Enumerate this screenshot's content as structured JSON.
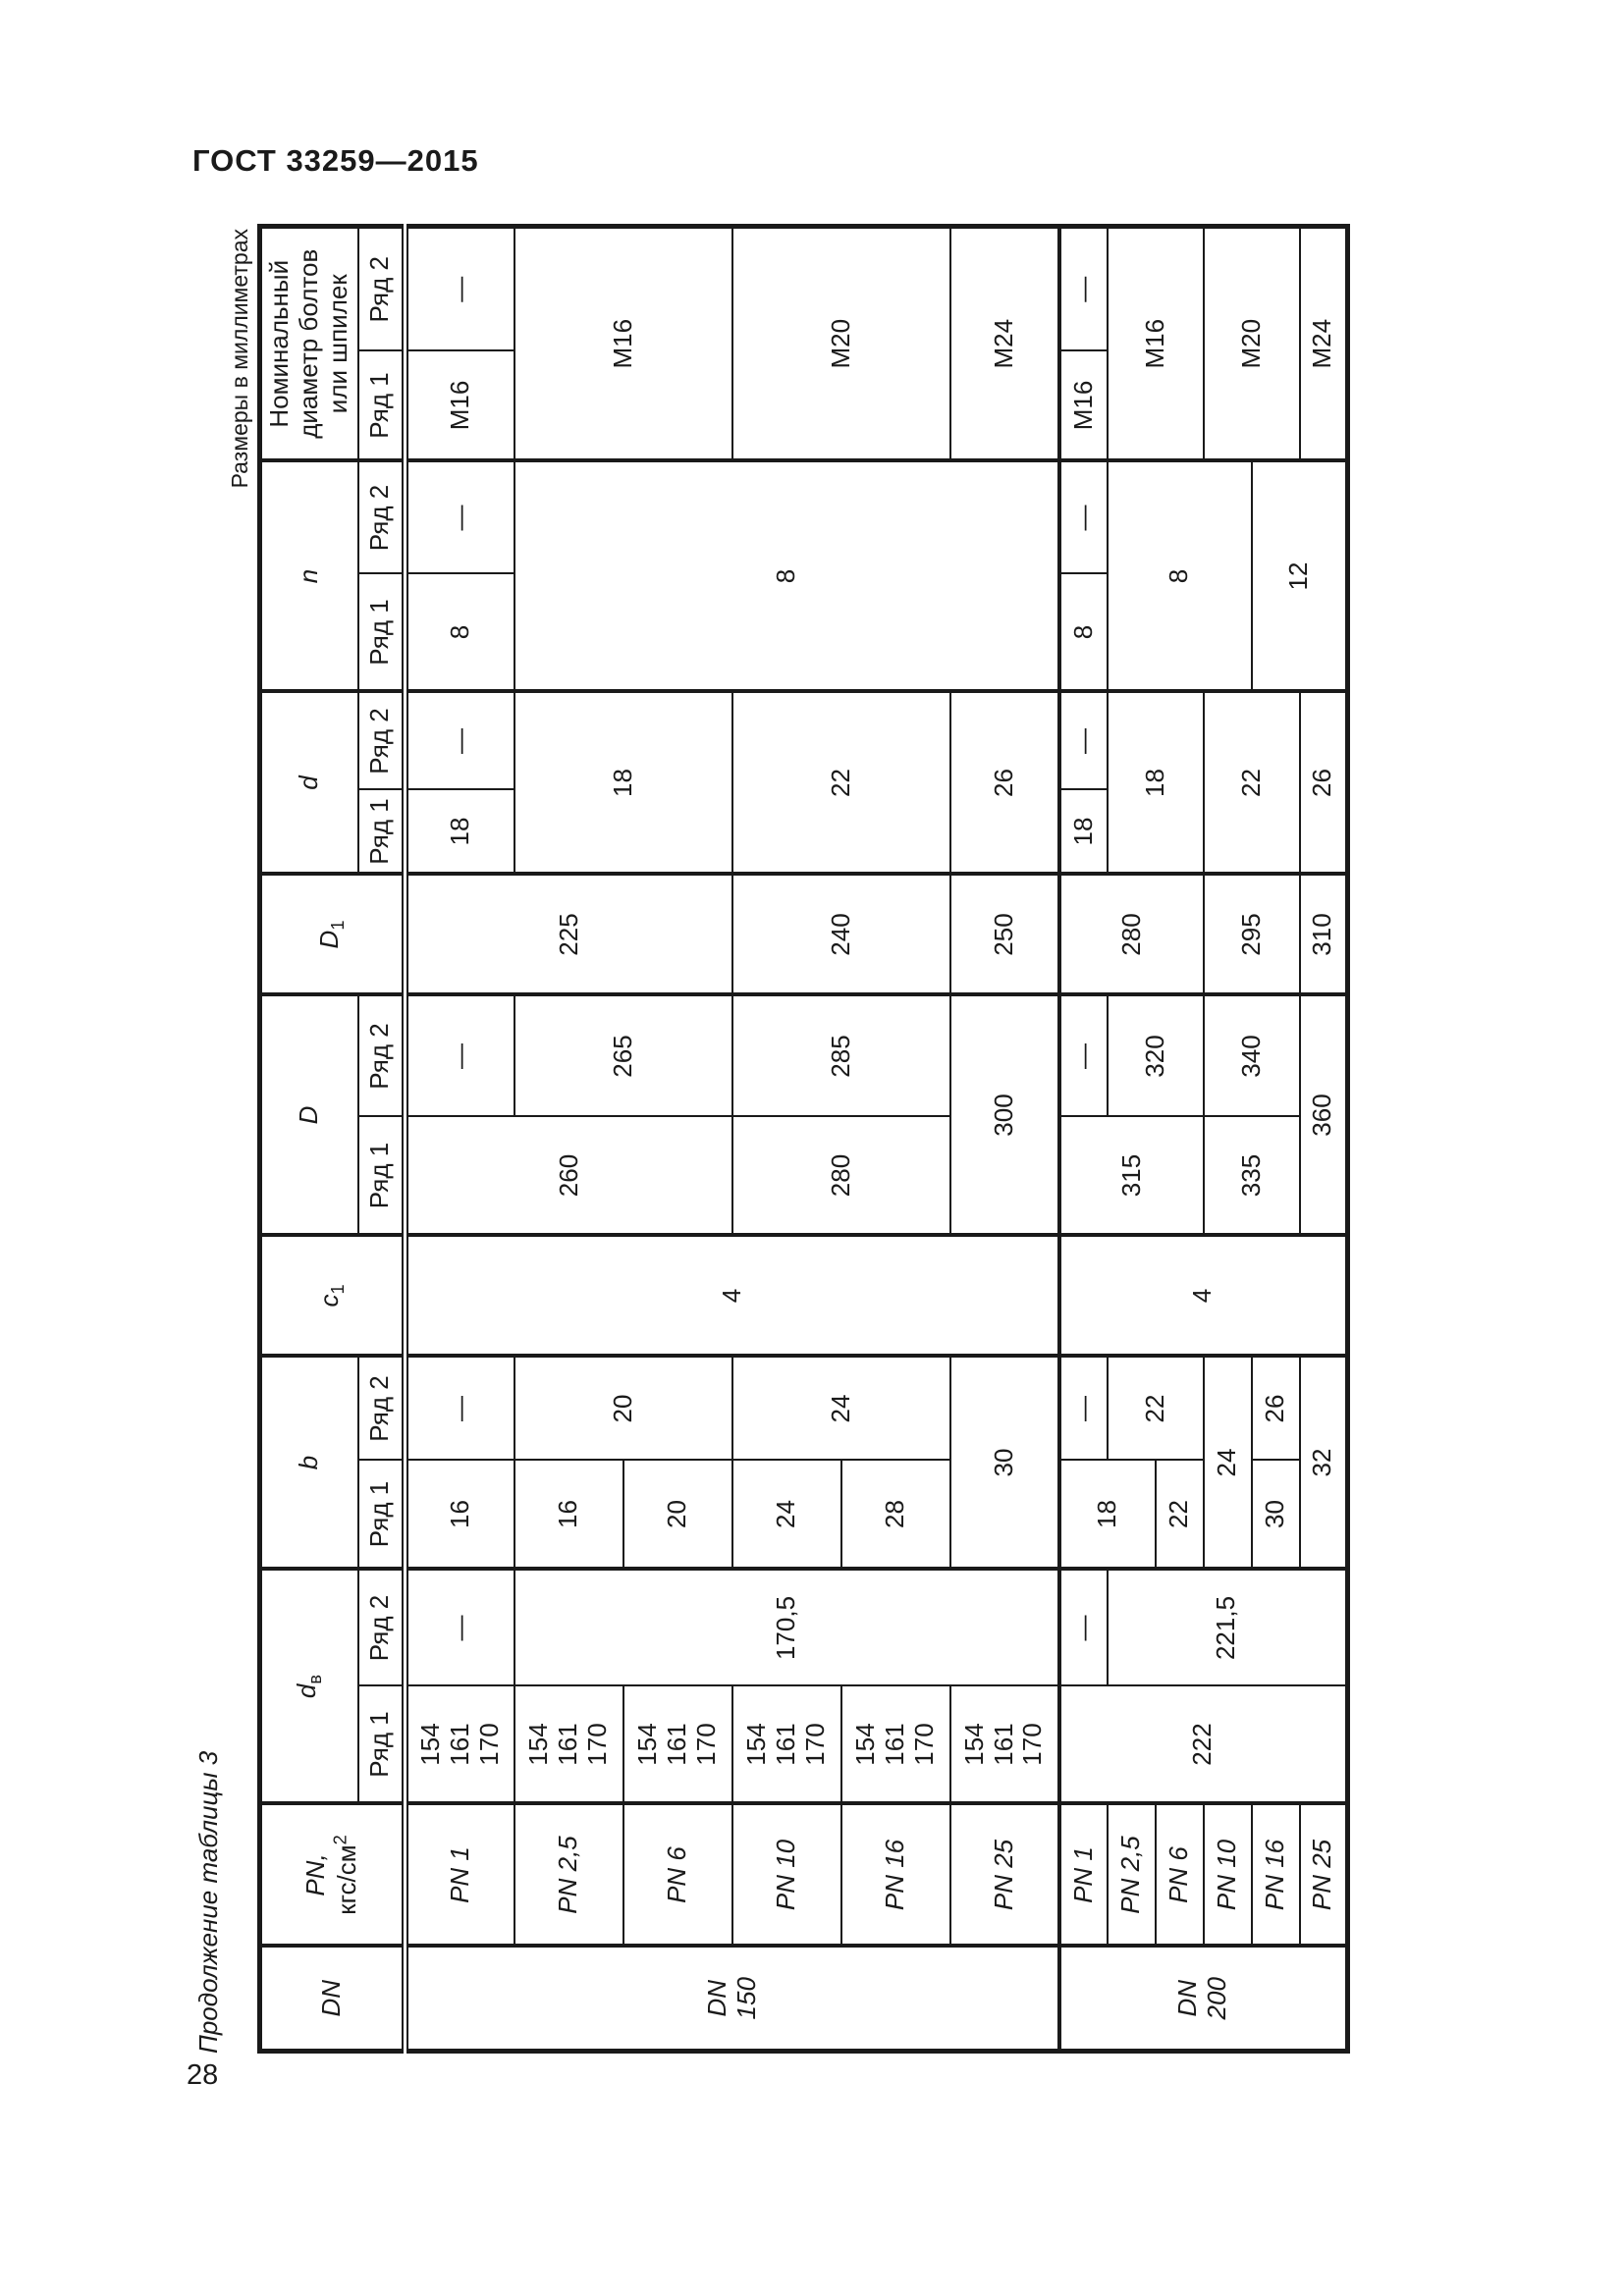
{
  "page": {
    "standard": "ГОСТ 33259—2015",
    "page_number": "28",
    "table_caption": "Продолжение таблицы 3",
    "units_caption": "Размеры в миллиметрах"
  },
  "sym": {
    "dash": "—"
  },
  "headers": {
    "dn": "DN",
    "pn_line1": "PN,",
    "pn_unit_base": "кгс/см",
    "pn_unit_sup": "2",
    "dv_base": "d",
    "dv_sub": "в",
    "b": "b",
    "c1_base": "c",
    "c1_sub": "1",
    "D": "D",
    "D1_base": "D",
    "D1_sub": "1",
    "d": "d",
    "n": "n",
    "bolt_line1": "Номинальный",
    "bolt_line2": "диаметр болтов",
    "bolt_line3": "или шпилек",
    "row1": "Ряд 1",
    "row2": "Ряд 2"
  },
  "dn150": {
    "dn_line1": "DN",
    "dn_line2": "150",
    "pn": [
      "PN 1",
      "PN 2,5",
      "PN 6",
      "PN 10",
      "PN 16",
      "PN 25"
    ],
    "dv_r1": [
      "154",
      "161",
      "170"
    ],
    "dv_r2_rest": "170,5",
    "b_r1": [
      "16",
      "16",
      "20",
      "24",
      "28"
    ],
    "b_r2_2_6": "20",
    "b_r2_10_16": "24",
    "b_pn25": "30",
    "c1": "4",
    "D_r1_1_6": "260",
    "D_r2_2_6": "265",
    "D_r1_10_16": "280",
    "D_r2_10_16": "285",
    "D_pn25": "300",
    "D1_1_6": "225",
    "D1_10_16": "240",
    "D1_pn25": "250",
    "d_r1_pn1": "18",
    "d_2_6": "18",
    "d_10_16": "22",
    "d_pn25": "26",
    "n_r1_pn1": "8",
    "n_2_25": "8",
    "bolt_r1_pn1": "M16",
    "bolt_2_6": "M16",
    "bolt_10_16": "M20",
    "bolt_pn25": "M24"
  },
  "dn200": {
    "dn_line1": "DN",
    "dn_line2": "200",
    "pn": [
      "PN 1",
      "PN 2,5",
      "PN 6",
      "PN 10",
      "PN 16",
      "PN 25"
    ],
    "dv_r1": "222",
    "dv_r2_rest": "221,5",
    "b_r1_1_2": "18",
    "b_r2_2_6": "22",
    "b_r1_pn6": "22",
    "b_pn10": "24",
    "b_r1_pn16": "30",
    "b_r2_pn16": "26",
    "b_pn25": "32",
    "c1": "4",
    "D_r1_1_6": "315",
    "D_r2_2_6": "320",
    "D_r1_10_16": "335",
    "D_r2_10_16": "340",
    "D_pn25": "360",
    "D1_1_6": "280",
    "D1_10_16": "295",
    "D1_pn25": "310",
    "d_r1_pn1": "18",
    "d_2_6": "18",
    "d_10_16": "22",
    "d_pn25": "26",
    "n_r1_pn1": "8",
    "n_2_10": "8",
    "n_16_25": "12",
    "bolt_r1_pn1": "M16",
    "bolt_2_6": "M16",
    "bolt_10_16": "M20",
    "bolt_pn25": "M24"
  }
}
